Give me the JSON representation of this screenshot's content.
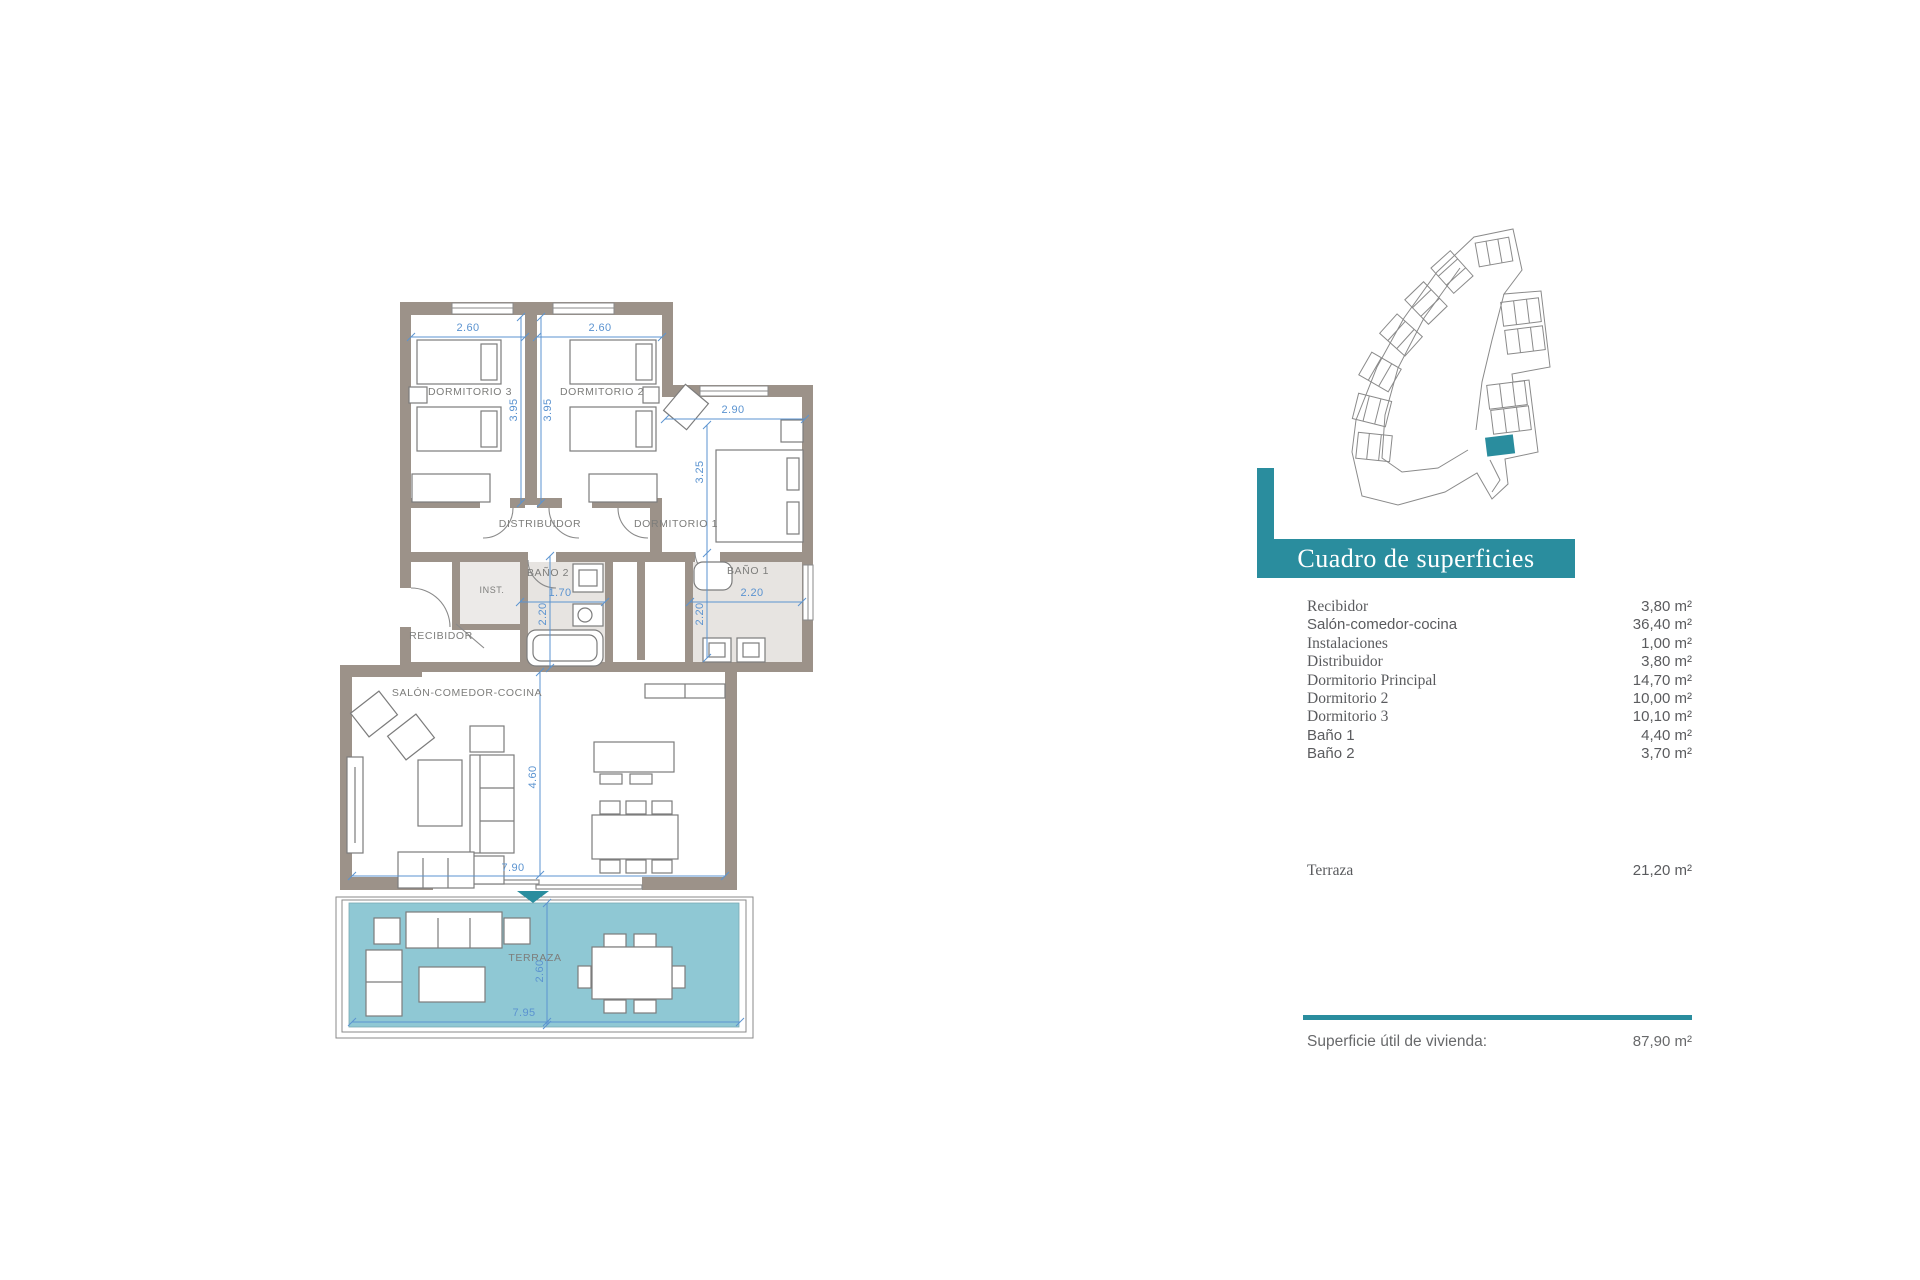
{
  "panel": {
    "title": "Cuadro de superficies",
    "rows": [
      {
        "label": "Recibidor",
        "value": "3,80 m²"
      },
      {
        "label": "Salón-comedor-cocina",
        "value": "36,40 m²"
      },
      {
        "label": "Instalaciones",
        "value": "1,00 m²"
      },
      {
        "label": "Distribuidor",
        "value": "3,80 m²"
      },
      {
        "label": "Dormitorio Principal",
        "value": "14,70 m²"
      },
      {
        "label": "Dormitorio 2",
        "value": "10,00 m²"
      },
      {
        "label": "Dormitorio 3",
        "value": "10,10 m²"
      },
      {
        "label": "Baño 1",
        "value": "4,40 m²"
      },
      {
        "label": "Baño 2",
        "value": "3,70 m²"
      }
    ],
    "terrace_row": {
      "label": "Terraza",
      "value": "21,20 m²"
    },
    "total_row": {
      "label": "Superficie útil de vivienda:",
      "value": "87,90 m²"
    }
  },
  "floorplan": {
    "room_labels": {
      "dormitorio3": "DORMITORIO 3",
      "dormitorio2": "DORMITORIO 2",
      "dormitorio1": "DORMITORIO 1",
      "distribuidor": "DISTRIBUIDOR",
      "recibidor": "RECIBIDOR",
      "instalaciones": "INST.",
      "bano2": "BAÑO 2",
      "bano1": "BAÑO 1",
      "salon": "SALÓN-COMEDOR-COCINA",
      "terraza": "TERRAZA"
    },
    "dimensions": {
      "dorm3_width": "2.60",
      "dorm2_width": "2.60",
      "dorm3_depth": "3.95",
      "dorm2_depth": "3.95",
      "dorm1_width": "2.90",
      "dorm1_depth": "3.25",
      "bano2_width": "1.70",
      "bano2_depth": "2.20",
      "bano1_width": "2.20",
      "bano1_depth": "2.20",
      "salon_depth": "4.60",
      "salon_width": "7.90",
      "terraza_depth": "2.60",
      "terraza_width": "7.95"
    },
    "colors": {
      "accent_teal": "#2A8D9E",
      "terrace_fill": "#8FC8D4",
      "wall": "#9C9289",
      "dimension_blue": "#5B93D0",
      "bath_floor": "#E7E4E1"
    }
  }
}
